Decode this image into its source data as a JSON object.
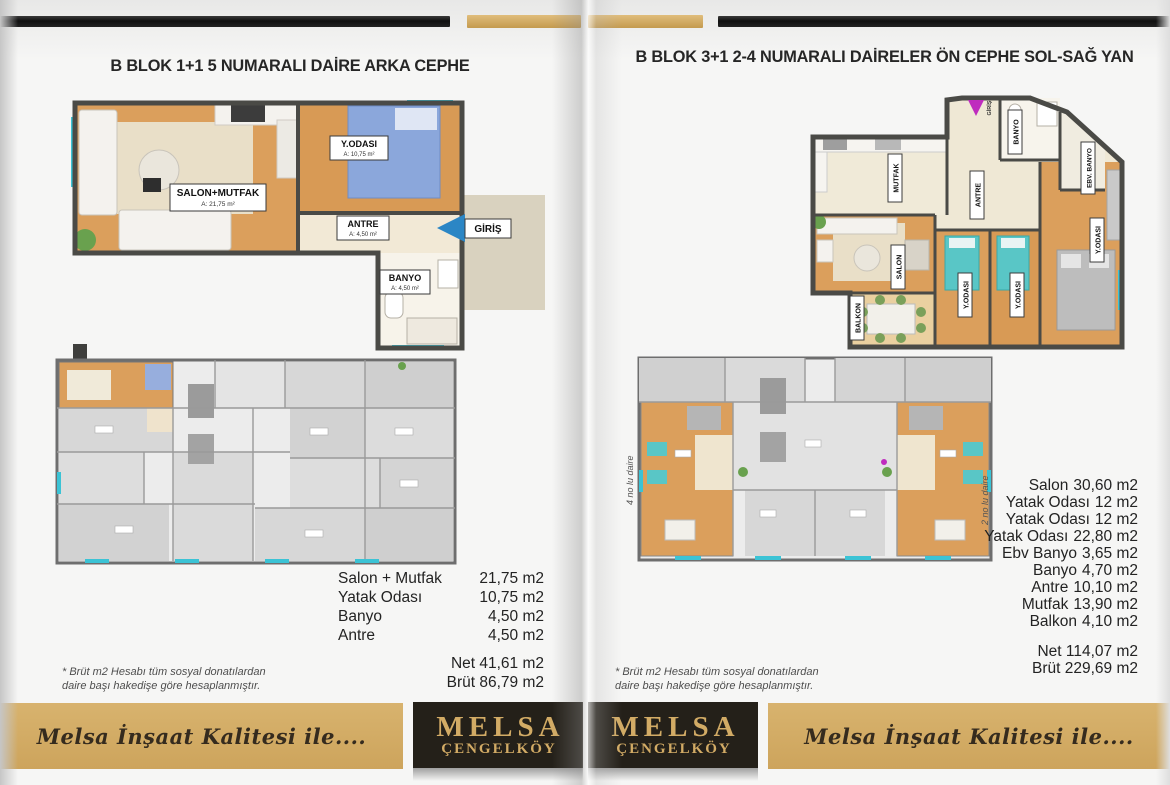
{
  "left": {
    "title": "B BLOK 1+1 5 NUMARALI DAİRE ARKA CEPHE",
    "plan": {
      "rooms": [
        {
          "name": "SALON+MUTFAK",
          "area": "A: 21,75 m²"
        },
        {
          "name": "Y.ODASI",
          "area": "A: 10,75 m²"
        },
        {
          "name": "ANTRE",
          "area": "A: 4,50 m²"
        },
        {
          "name": "BANYO",
          "area": "A: 4,50 m²"
        }
      ],
      "entrance_label": "GİRİŞ"
    },
    "measurements": {
      "rows": [
        {
          "label": "Salon + Mutfak",
          "value": "21,75 m2"
        },
        {
          "label": "Yatak Odası",
          "value": "10,75 m2"
        },
        {
          "label": "Banyo",
          "value": "4,50 m2"
        },
        {
          "label": "Antre",
          "value": "4,50 m2"
        }
      ],
      "net": "Net 41,61 m2",
      "brut": "Brüt 86,79 m2"
    },
    "footnote": {
      "line1": "* Brüt m2 Hesabı tüm sosyal donatılardan",
      "line2": "daire başı hakedişe göre hesaplanmıştır."
    },
    "banner_text": "Melsa İnşaat Kalitesi ile....",
    "logo": {
      "line1": "MELSA",
      "line2": "ÇENGELKÖY"
    }
  },
  "right": {
    "title": "B BLOK 3+1 2-4 NUMARALI DAİRELER ÖN CEPHE SOL-SAĞ YAN",
    "plan": {
      "room_labels": [
        "MUTFAK",
        "ANTRE",
        "BANYO",
        "EBV. BANYO",
        "SALON",
        "Y.ODASI",
        "Y.ODASI",
        "Y.ODASI",
        "BALKON"
      ],
      "entrance_label": "GİRİŞ"
    },
    "site_plan": {
      "left_label": "4 no lu daire",
      "right_label": "2 no lu daire"
    },
    "measurements": {
      "rows": [
        {
          "label": "Salon",
          "value": "30,60 m2"
        },
        {
          "label": "Yatak Odası",
          "value": "12 m2"
        },
        {
          "label": "Yatak Odası",
          "value": "12 m2"
        },
        {
          "label": "Yatak Odası",
          "value": "22,80 m2"
        },
        {
          "label": "Ebv Banyo",
          "value": "3,65 m2"
        },
        {
          "label": "Banyo",
          "value": "4,70 m2"
        },
        {
          "label": "Antre",
          "value": "10,10 m2"
        },
        {
          "label": "Mutfak",
          "value": "13,90 m2"
        },
        {
          "label": "Balkon",
          "value": "4,10 m2"
        }
      ],
      "net": "Net 114,07  m2",
      "brut": "Brüt 229,69 m2"
    },
    "footnote": {
      "line1": "* Brüt m2 Hesabı tüm sosyal donatılardan",
      "line2": "daire başı hakedişe göre hesaplanmıştır."
    },
    "banner_text": "Melsa İnşaat Kalitesi ile....",
    "logo": {
      "line1": "MELSA",
      "line2": "ÇENGELKÖY"
    }
  },
  "colors": {
    "gold": "#d2ab65",
    "logo_bg": "#242019",
    "wood": "#db9f5c",
    "teal": "#3bc3d5",
    "bed_blue": "#8ba7db",
    "bed_teal": "#59c6c6",
    "arrow_blue": "#2b86c5",
    "arrow_magenta": "#bf2cbe"
  }
}
